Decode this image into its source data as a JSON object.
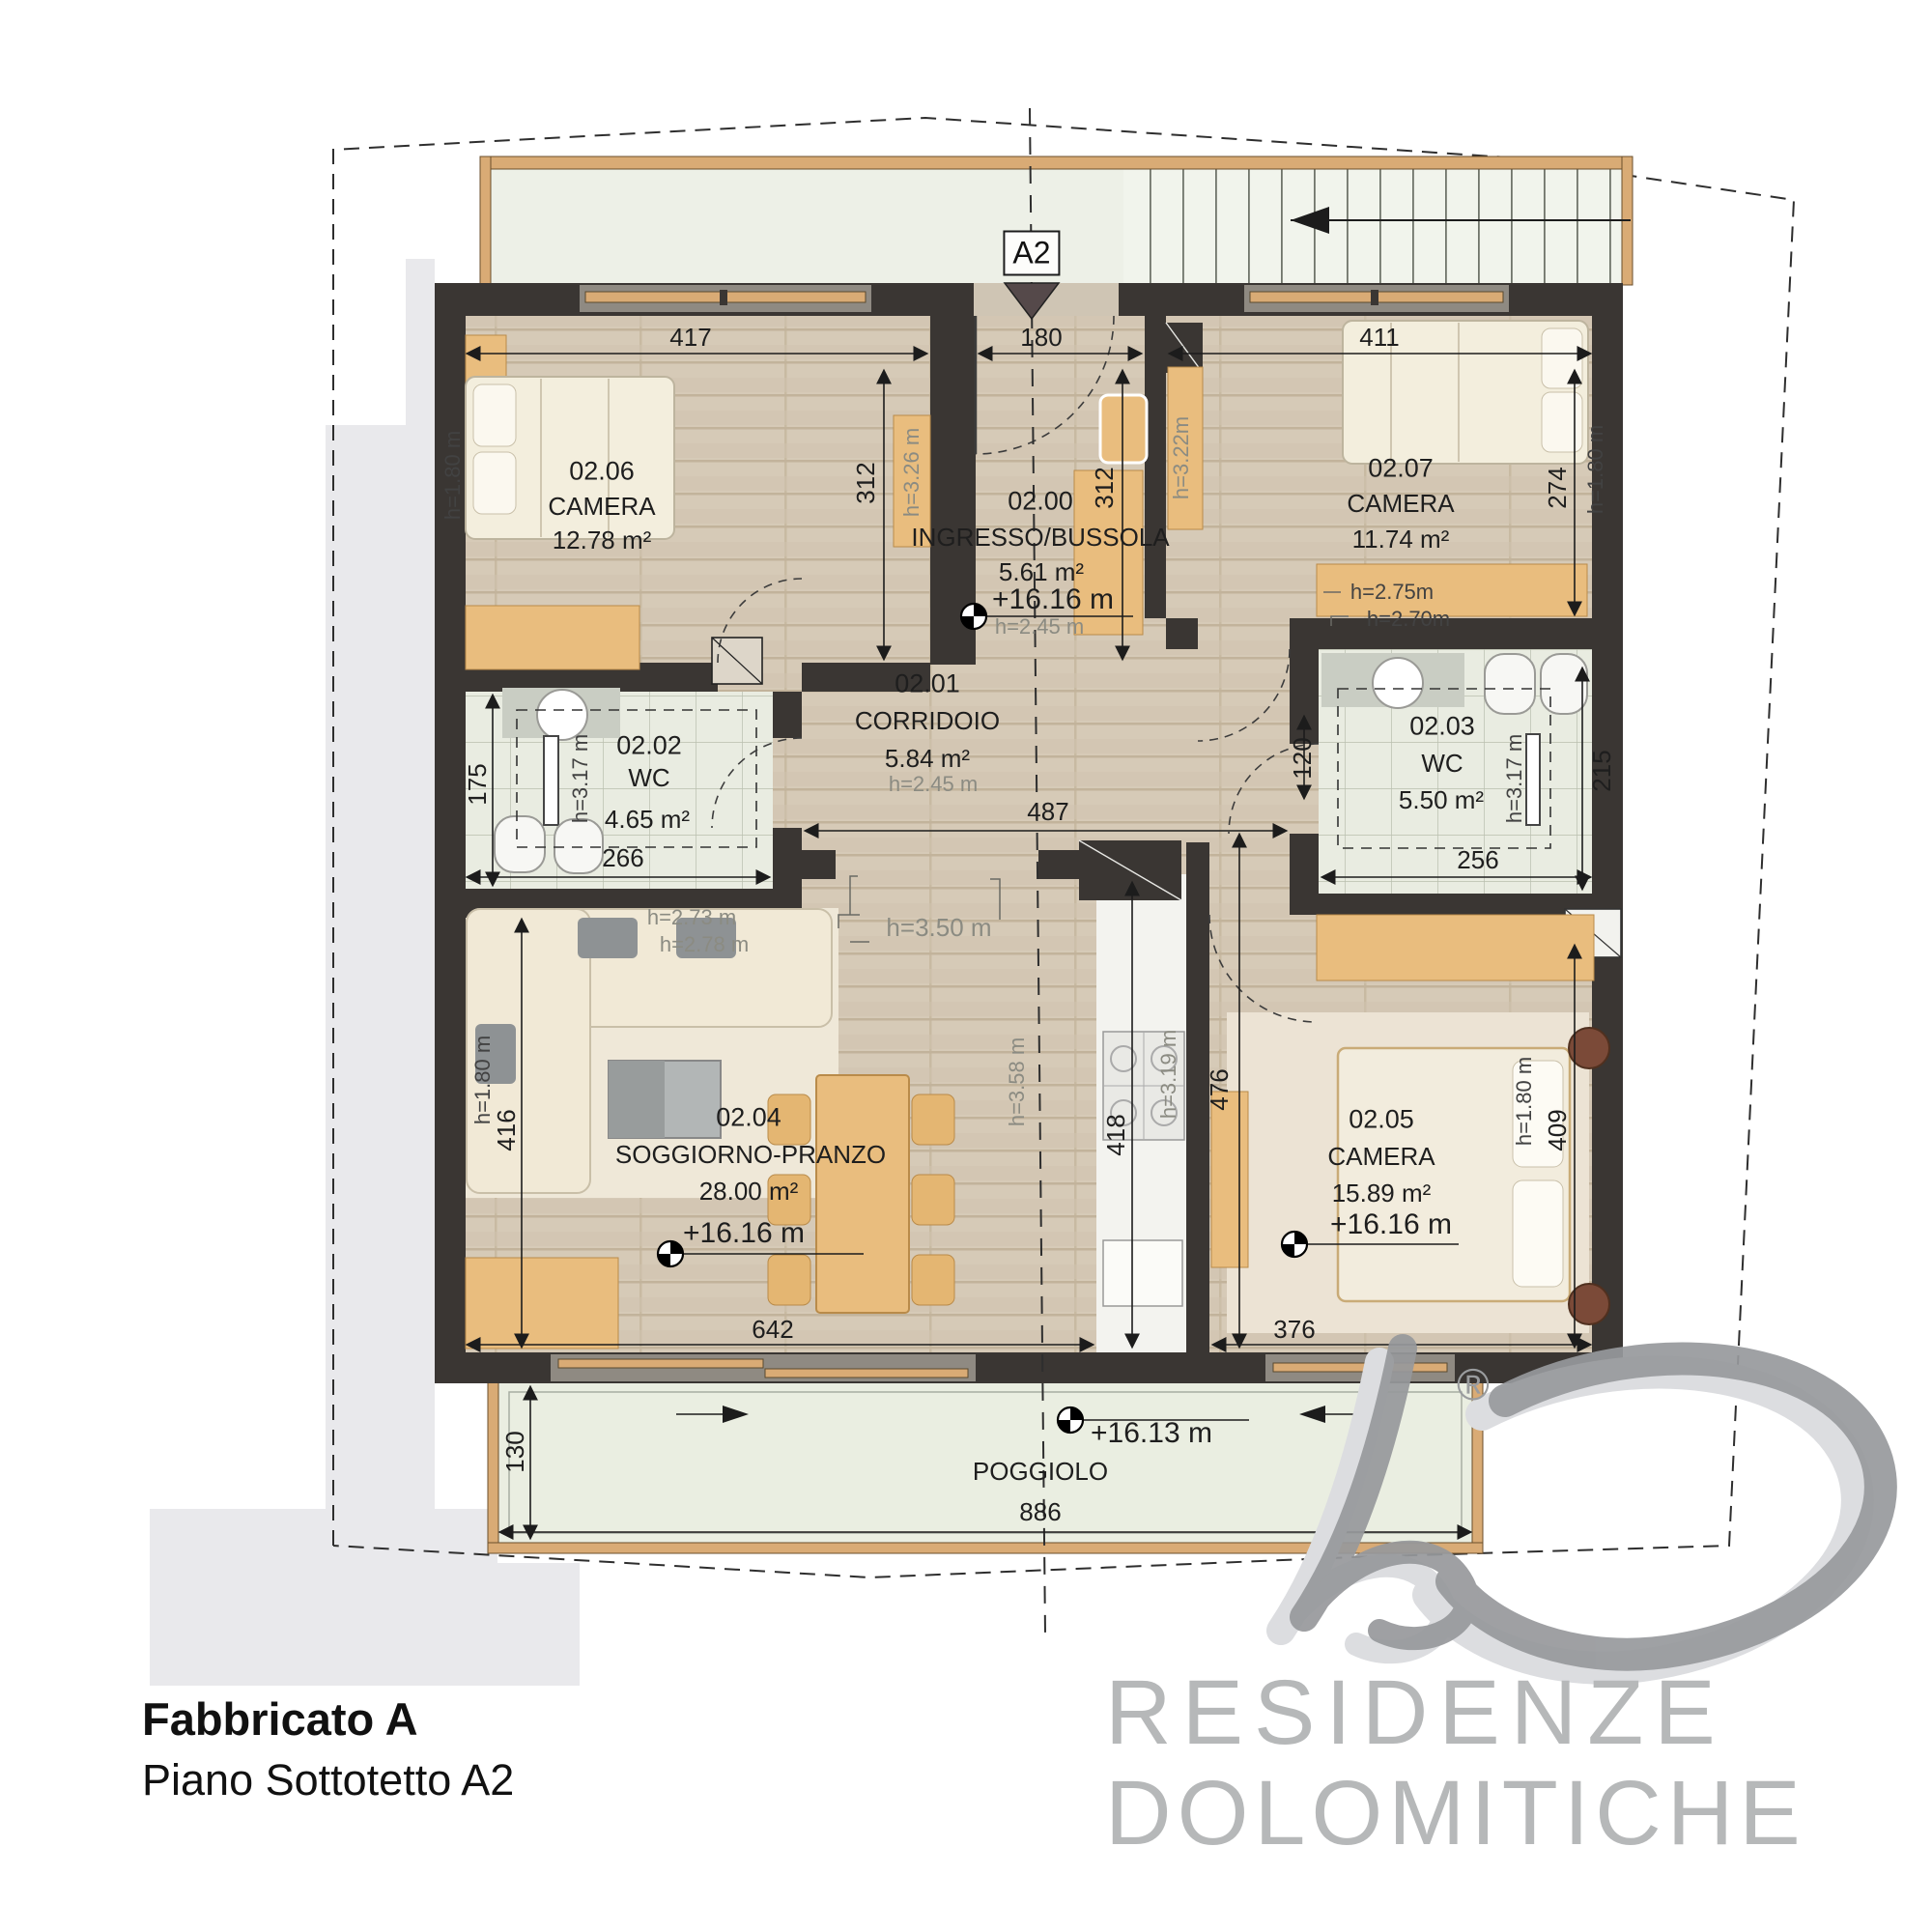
{
  "title": {
    "line1": "Fabbricato A",
    "line2": "Piano Sottotetto A2"
  },
  "section": {
    "marker": "A2"
  },
  "logo": {
    "line1": "RESIDENZE",
    "line2": "DOLOMITICHE",
    "registered": "®"
  },
  "balcony": {
    "name": "POGGIOLO",
    "elevation": "+16.13 m",
    "width": "886",
    "depth": "130"
  },
  "rooms": [
    {
      "number": "02.00",
      "name": "INGRESSO/BUSSOLA",
      "area": "5.61 m²",
      "elevation": "+16.16 m",
      "height": "h=2.45 m"
    },
    {
      "number": "02.01",
      "name": "CORRIDOIO",
      "area": "5.84 m²",
      "height": "h=2.45 m"
    },
    {
      "number": "02.02",
      "name": "WC",
      "area": "4.65 m²"
    },
    {
      "number": "02.03",
      "name": "WC",
      "area": "5.50 m²"
    },
    {
      "number": "02.04",
      "name": "SOGGIORNO-PRANZO",
      "area": "28.00 m²",
      "elevation": "+16.16 m"
    },
    {
      "number": "02.05",
      "name": "CAMERA",
      "area": "15.89 m²",
      "elevation": "+16.16 m"
    },
    {
      "number": "02.06",
      "name": "CAMERA",
      "area": "12.78 m²"
    },
    {
      "number": "02.07",
      "name": "CAMERA",
      "area": "11.74 m²"
    }
  ],
  "dims": {
    "room206_width": "417",
    "ingresso_width": "180",
    "room207_width": "411",
    "room206_depth": "312",
    "ingresso_depth": "312",
    "room207_depth": "274",
    "wc02_depth": "175",
    "wc02_width": "266",
    "corridor_width": "487",
    "wc03_offset": "120",
    "wc03_depth": "215",
    "wc03_width": "256",
    "living_depth": "416",
    "living_width": "642",
    "room205_width": "376",
    "room205_depth": "409",
    "kitchen_depth": "418",
    "passage_depth": "476"
  },
  "heights": {
    "bed206": "h=1.80 m",
    "wardrobe206": "h=3.26 m",
    "wardrobe200": "h=3.22m",
    "bed207": "h=1.80 m",
    "wardrobe207_a": "h=2.75m",
    "wardrobe207_b": "h=2.70m",
    "wc02": "h=3.17 m",
    "wc03": "h=3.17 m",
    "opening": "h=3.50 m",
    "sofa_a": "h=2.73 m",
    "sofa_b": "h=2.78 m",
    "ridge": "h=3.58 m",
    "kitchen": "h=3.19 m",
    "living": "h=1.80 m",
    "bed205": "h=1.80 m"
  },
  "colors": {
    "wall": "#3a3633",
    "wood_accent": "#e9bd7e",
    "logo_gray": "#b6b8b9",
    "terrace": "#edf0e7"
  }
}
